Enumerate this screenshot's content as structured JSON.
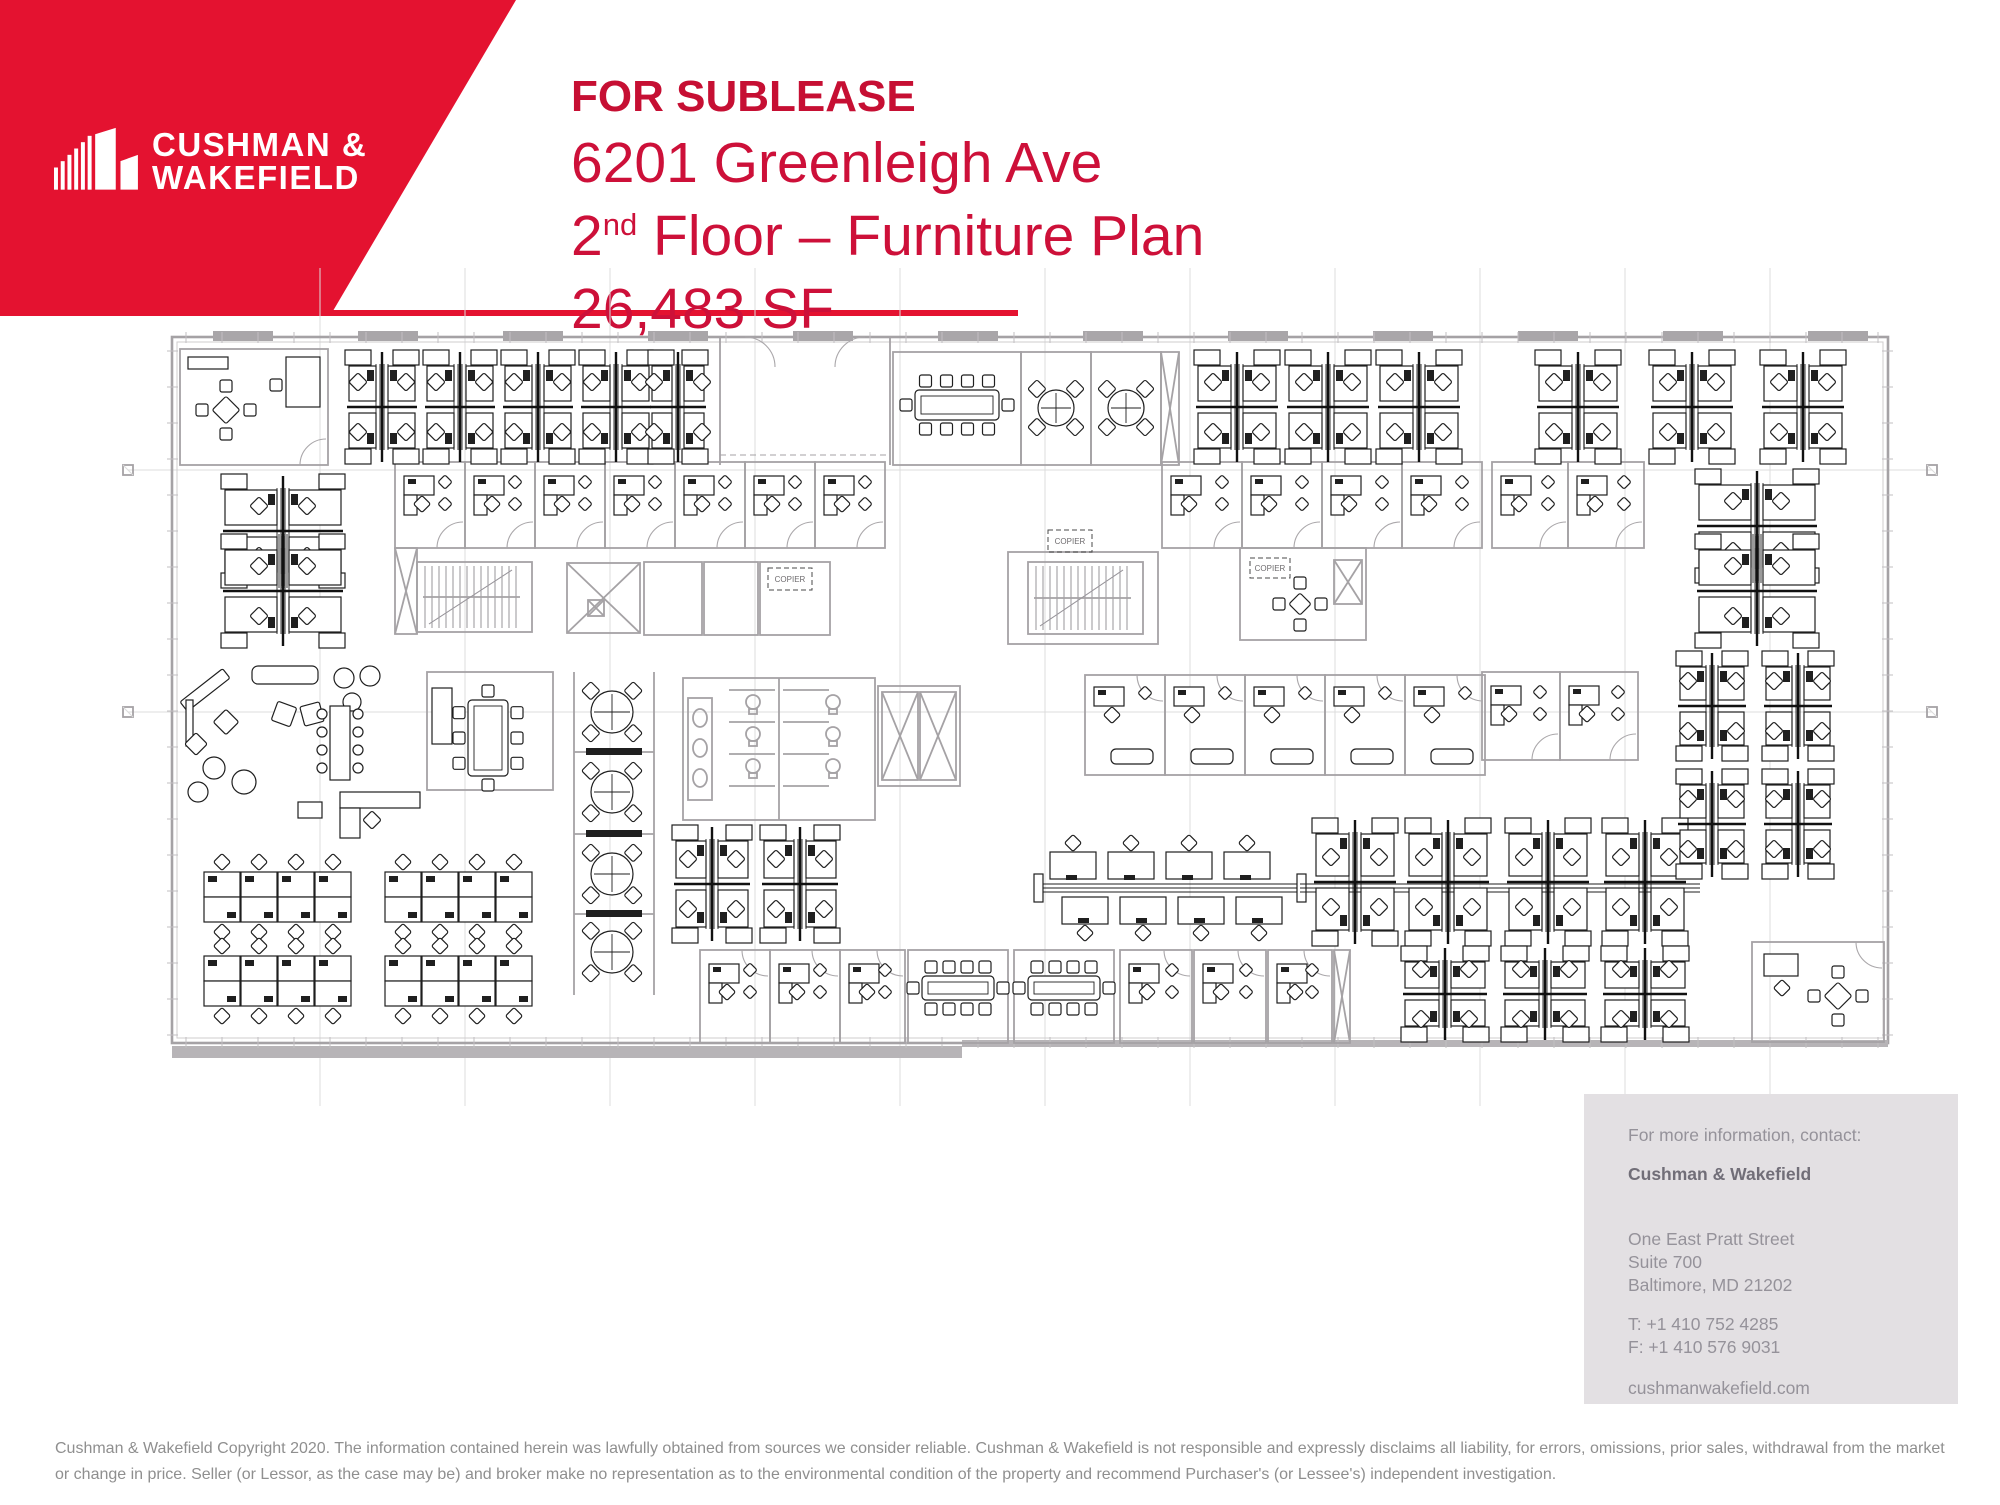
{
  "brand": {
    "logo_line1": "CUSHMAN &",
    "logo_line2": "WAKEFIELD",
    "banner_color": "#e41230",
    "headline_color": "#cd1039"
  },
  "header": {
    "status": "FOR SUBLEASE",
    "address": "6201 Greenleigh Ave",
    "floor_pre": "2",
    "floor_sup": "nd",
    "floor_post": " Floor – Furniture Plan",
    "size": "26,483 SF"
  },
  "contact": {
    "intro": "For more information, contact:",
    "name": "Cushman & Wakefield",
    "address1": "One East Pratt Street",
    "address2": "Suite 700",
    "address3": "Baltimore, MD 21202",
    "phone": "T: +1 410 752 4285",
    "fax": "F: +1 410 576 9031",
    "website": "cushmanwakefield.com"
  },
  "footer": {
    "disclaimer": "Cushman & Wakefield Copyright 2020. The information contained herein was lawfully obtained from sources we consider reliable. Cushman & Wakefield is not responsible and expressly disclaims all liability, for errors, omissions, prior sales,  withdrawal from the market or change in price. Seller (or Lessor, as the case may be) and broker make no representation as to the environmental condition of the property and recommend Purchaser's (or Lessee's) independent investigation."
  },
  "plan": {
    "copier_label": "COPIER",
    "outline": {
      "x": 172,
      "y": 337,
      "w": 1716,
      "h": 706
    },
    "sills": [
      [
        172,
        1046,
        790,
        12
      ],
      [
        962,
        1040,
        926,
        7
      ]
    ],
    "stub_xs": [
      243,
      388,
      533,
      678,
      823,
      968,
      1113,
      1258,
      1403,
      1548,
      1693,
      1838
    ],
    "grid_v": [
      320,
      465,
      610,
      755,
      900,
      1045,
      1190,
      1335,
      1480,
      1625,
      1770
    ],
    "grid_h": [
      470,
      712
    ],
    "markers": [
      [
        128,
        470
      ],
      [
        128,
        712
      ],
      [
        1932,
        470
      ],
      [
        1932,
        712
      ]
    ],
    "quad_clusters": [
      [
        382,
        407,
        74,
        114
      ],
      [
        460,
        407,
        74,
        114
      ],
      [
        538,
        407,
        74,
        114
      ],
      [
        616,
        407,
        74,
        114
      ],
      [
        678,
        407,
        60,
        114
      ],
      [
        1237,
        407,
        86,
        114
      ],
      [
        1328,
        407,
        86,
        114
      ],
      [
        1419,
        407,
        86,
        114
      ],
      [
        1578,
        407,
        86,
        114
      ],
      [
        1692,
        407,
        86,
        114
      ],
      [
        1803,
        407,
        86,
        114
      ],
      [
        712,
        884,
        80,
        118
      ],
      [
        800,
        884,
        80,
        118
      ],
      [
        1355,
        882,
        86,
        128
      ],
      [
        1448,
        882,
        86,
        128
      ],
      [
        1548,
        882,
        86,
        128
      ],
      [
        1645,
        882,
        86,
        128
      ],
      [
        1712,
        706,
        72,
        110
      ],
      [
        1798,
        706,
        72,
        110
      ],
      [
        1712,
        824,
        72,
        110
      ],
      [
        1798,
        824,
        72,
        110
      ],
      [
        1445,
        994,
        88,
        96
      ],
      [
        1545,
        994,
        88,
        96
      ],
      [
        1645,
        994,
        88,
        96
      ]
    ],
    "wide_clusters": [
      [
        283,
        474,
        648,
        124
      ],
      [
        1757,
        469,
        648,
        124
      ]
    ],
    "offices": [
      {
        "x": 180,
        "y": 349,
        "w": 148,
        "h": 116,
        "v": "tl",
        "door": "b"
      },
      {
        "x": 395,
        "y": 462,
        "w": 70,
        "h": 86,
        "v": "desk",
        "door": "b"
      },
      {
        "x": 465,
        "y": 462,
        "w": 70,
        "h": 86,
        "v": "desk",
        "door": "b"
      },
      {
        "x": 535,
        "y": 462,
        "w": 70,
        "h": 86,
        "v": "desk",
        "door": "b"
      },
      {
        "x": 605,
        "y": 462,
        "w": 70,
        "h": 86,
        "v": "desk",
        "door": "b"
      },
      {
        "x": 675,
        "y": 462,
        "w": 70,
        "h": 86,
        "v": "desk",
        "door": "b"
      },
      {
        "x": 745,
        "y": 462,
        "w": 70,
        "h": 86,
        "v": "desk",
        "door": "b"
      },
      {
        "x": 815,
        "y": 462,
        "w": 70,
        "h": 86,
        "v": "desk",
        "door": "b"
      },
      {
        "x": 1162,
        "y": 462,
        "w": 80,
        "h": 86,
        "v": "desk",
        "door": "b"
      },
      {
        "x": 1242,
        "y": 462,
        "w": 80,
        "h": 86,
        "v": "desk",
        "door": "b"
      },
      {
        "x": 1322,
        "y": 462,
        "w": 80,
        "h": 86,
        "v": "desk",
        "door": "b"
      },
      {
        "x": 1402,
        "y": 462,
        "w": 80,
        "h": 86,
        "v": "desk",
        "door": "b"
      },
      {
        "x": 1492,
        "y": 462,
        "w": 76,
        "h": 86,
        "v": "desk",
        "door": "b"
      },
      {
        "x": 1568,
        "y": 462,
        "w": 76,
        "h": 86,
        "v": "desk",
        "door": "b"
      },
      {
        "x": 1482,
        "y": 672,
        "w": 78,
        "h": 88,
        "v": "desk",
        "door": "b"
      },
      {
        "x": 1560,
        "y": 672,
        "w": 78,
        "h": 88,
        "v": "desk",
        "door": "b"
      },
      {
        "x": 1085,
        "y": 675,
        "w": 80,
        "h": 100,
        "v": "sofa",
        "door": "t"
      },
      {
        "x": 1165,
        "y": 675,
        "w": 80,
        "h": 100,
        "v": "sofa",
        "door": "t"
      },
      {
        "x": 1245,
        "y": 675,
        "w": 80,
        "h": 100,
        "v": "sofa",
        "door": "t"
      },
      {
        "x": 1325,
        "y": 675,
        "w": 80,
        "h": 100,
        "v": "sofa",
        "door": "t"
      },
      {
        "x": 1405,
        "y": 675,
        "w": 80,
        "h": 100,
        "v": "sofa",
        "door": "t"
      },
      {
        "x": 700,
        "y": 950,
        "w": 70,
        "h": 93,
        "v": "desk",
        "door": "t"
      },
      {
        "x": 770,
        "y": 950,
        "w": 70,
        "h": 93,
        "v": "desk",
        "door": "t"
      },
      {
        "x": 840,
        "y": 950,
        "w": 65,
        "h": 93,
        "v": "desk",
        "door": "t"
      },
      {
        "x": 1120,
        "y": 950,
        "w": 72,
        "h": 93,
        "v": "desk",
        "door": "t"
      },
      {
        "x": 1194,
        "y": 950,
        "w": 72,
        "h": 93,
        "v": "desk",
        "door": "t"
      },
      {
        "x": 1268,
        "y": 950,
        "w": 64,
        "h": 93,
        "v": "desk",
        "door": "t"
      },
      {
        "x": 1752,
        "y": 942,
        "w": 132,
        "h": 100,
        "v": "br2",
        "door": "t"
      }
    ],
    "conf_rooms": [
      {
        "room": [
          893,
          352,
          128,
          113
        ],
        "table": [
          915,
          390,
          84,
          30
        ],
        "o": "h"
      },
      {
        "room": [
          427,
          672,
          126,
          118
        ],
        "table": [
          468,
          700,
          40,
          76
        ],
        "o": "v"
      },
      {
        "room": [
          908,
          950,
          100,
          93
        ],
        "table": [
          922,
          976,
          72,
          24
        ],
        "o": "h"
      },
      {
        "room": [
          1014,
          950,
          100,
          93
        ],
        "table": [
          1028,
          976,
          72,
          24
        ],
        "o": "h"
      }
    ],
    "round_rooms": [
      {
        "room": [
          1021,
          352,
          70,
          113
        ],
        "t": [
          1056,
          408,
          18
        ]
      },
      {
        "room": [
          1091,
          352,
          70,
          113
        ],
        "t": [
          1126,
          408,
          18
        ]
      }
    ],
    "huddle": {
      "x1": 574,
      "x2": 654,
      "y1": 672,
      "y2": 995,
      "tables": [
        [
          612,
          712
        ],
        [
          612,
          792
        ],
        [
          612,
          874
        ],
        [
          612,
          952
        ]
      ],
      "dividers": [
        752,
        834,
        914
      ]
    },
    "stairs": [
      [
        417,
        562,
        115,
        70
      ],
      [
        1028,
        562,
        115,
        72
      ]
    ],
    "elev_shaft": [
      567,
      563,
      73,
      70
    ],
    "elev_lobby": [
      878,
      686,
      82,
      100
    ],
    "elevators": [
      [
        588,
        600,
        16,
        16
      ],
      [
        882,
        692,
        36,
        88
      ],
      [
        920,
        692,
        36,
        88
      ],
      [
        1334,
        560,
        28,
        44
      ]
    ],
    "restroom": [
      683,
      678,
      192,
      142
    ],
    "closets": [
      [
        1161,
        352,
        18,
        113
      ],
      [
        395,
        548,
        22,
        86
      ],
      [
        1334,
        950,
        16,
        93
      ]
    ],
    "small_rooms": [
      [
        644,
        562,
        58,
        73
      ],
      [
        704,
        562,
        54,
        73
      ],
      [
        760,
        562,
        70,
        73
      ],
      [
        1008,
        552,
        150,
        92
      ],
      [
        1240,
        548,
        126,
        92
      ]
    ],
    "copiers": [
      [
        768,
        568,
        44,
        22
      ],
      [
        1048,
        530,
        44,
        22
      ],
      [
        1250,
        558,
        40,
        20
      ]
    ],
    "xtables": [
      [
        226,
        410,
        15
      ],
      [
        1838,
        996,
        15
      ],
      [
        1300,
        604,
        12
      ]
    ],
    "vestibule": {
      "x1": 720,
      "x2": 890,
      "y1": 337,
      "y2": 465
    },
    "bench": [
      1040,
      1300,
      888
    ],
    "spine_ext": [
      1300,
      1700,
      888
    ],
    "training": [
      [
        204,
        862
      ],
      [
        204,
        946
      ],
      [
        385,
        862
      ],
      [
        385,
        946
      ]
    ],
    "lounge": [
      [
        "rr",
        252,
        666,
        66,
        18
      ],
      [
        "rot",
        205,
        690,
        54,
        12,
        -38
      ],
      [
        "r",
        186,
        700,
        7,
        46
      ],
      [
        "c",
        344,
        678,
        10
      ],
      [
        "c",
        370,
        676,
        10
      ],
      [
        "c",
        352,
        702,
        9
      ],
      [
        "rot",
        226,
        722,
        18,
        18,
        45
      ],
      [
        "rot",
        196,
        744,
        16,
        16,
        45
      ],
      [
        "c",
        214,
        768,
        11
      ],
      [
        "c",
        244,
        782,
        12
      ],
      [
        "c",
        198,
        792,
        10
      ],
      [
        "rot",
        284,
        714,
        20,
        20,
        20
      ],
      [
        "rot",
        312,
        714,
        20,
        20,
        -15
      ],
      [
        "r",
        330,
        706,
        20,
        74
      ],
      [
        "c",
        322,
        714,
        5
      ],
      [
        "c",
        322,
        732,
        5
      ],
      [
        "c",
        322,
        750,
        5
      ],
      [
        "c",
        322,
        768,
        5
      ],
      [
        "c",
        358,
        714,
        5
      ],
      [
        "c",
        358,
        732,
        5
      ],
      [
        "c",
        358,
        750,
        5
      ],
      [
        "c",
        358,
        768,
        5
      ],
      [
        "r",
        340,
        792,
        80,
        16
      ],
      [
        "r",
        340,
        808,
        20,
        30
      ],
      [
        "rot",
        372,
        820,
        13,
        13,
        45
      ],
      [
        "r",
        298,
        802,
        24,
        16
      ]
    ]
  }
}
